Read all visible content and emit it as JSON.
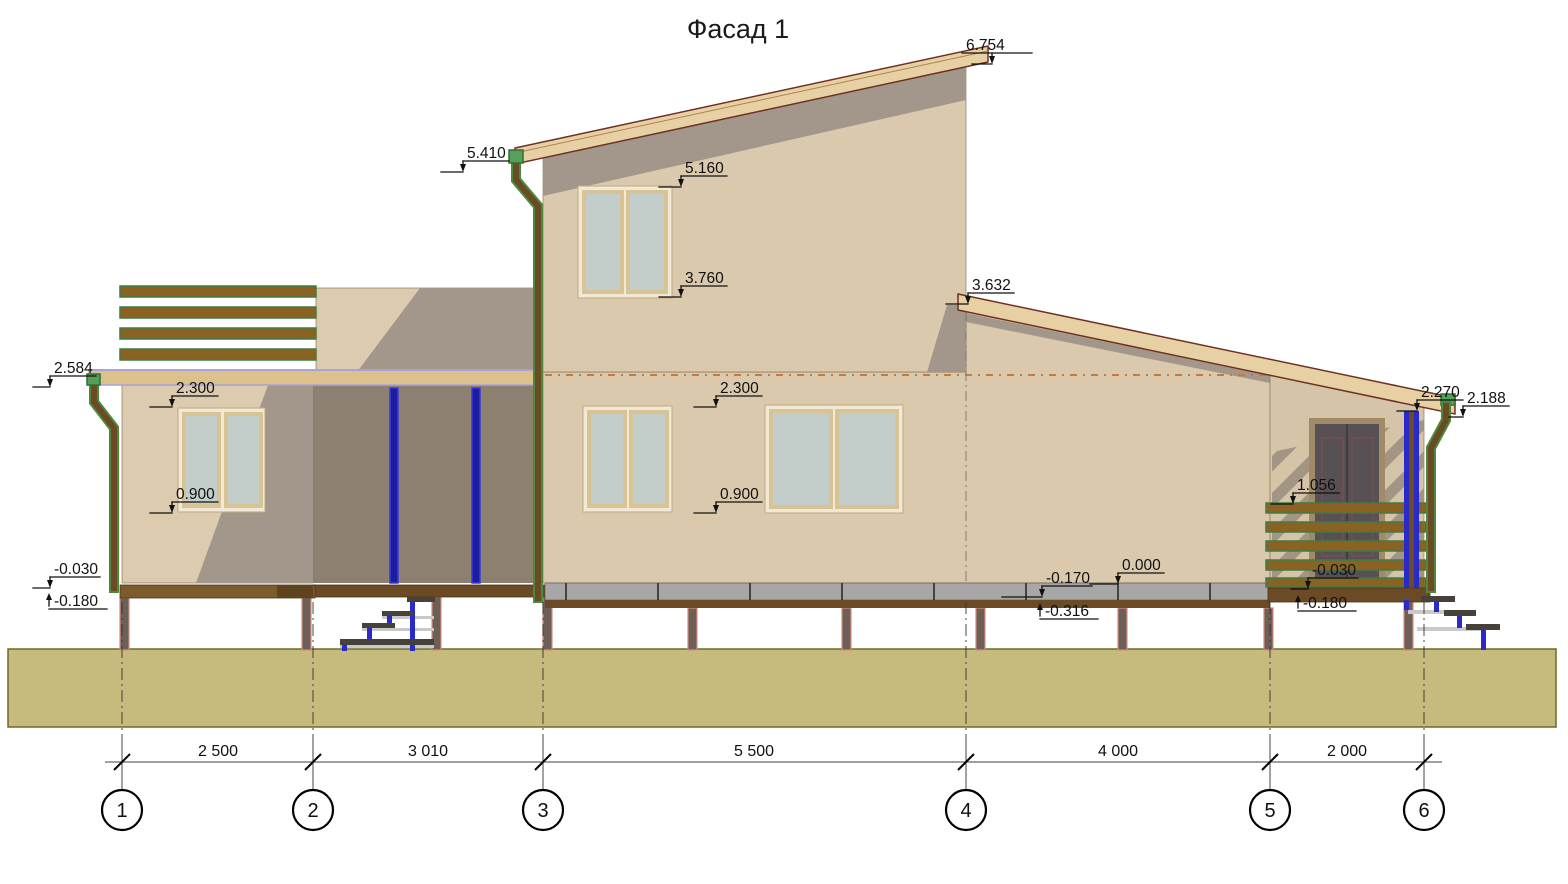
{
  "title": "Фасад 1",
  "markers": [
    {
      "name": "roof-high-peak",
      "value": "6.754"
    },
    {
      "name": "roof-high-eave",
      "value": "5.410"
    },
    {
      "name": "upper-window-top",
      "value": "5.160"
    },
    {
      "name": "upper-window-bottom",
      "value": "3.760"
    },
    {
      "name": "low-roof-start",
      "value": "3.632"
    },
    {
      "name": "left-wing-roof",
      "value": "2.584"
    },
    {
      "name": "left-window-top",
      "value": "2.300"
    },
    {
      "name": "left-window-bottom",
      "value": "0.900"
    },
    {
      "name": "main-window-top",
      "value": "2.300"
    },
    {
      "name": "main-window-bottom",
      "value": "0.900"
    },
    {
      "name": "porch-roof-under",
      "value": "2.270"
    },
    {
      "name": "porch-roof-tip",
      "value": "2.188"
    },
    {
      "name": "railing-top",
      "value": "1.056"
    },
    {
      "name": "floor-zero",
      "value": "0.000"
    },
    {
      "name": "plinth-bottom",
      "value": "-0.170"
    },
    {
      "name": "left-base-top",
      "value": "-0.030"
    },
    {
      "name": "porch-base-top",
      "value": "-0.030"
    },
    {
      "name": "left-base-bottom",
      "value": "-0.180"
    },
    {
      "name": "main-base-bottom",
      "value": "-0.316"
    },
    {
      "name": "porch-base-bottom",
      "value": "-0.180"
    }
  ],
  "dimensions": {
    "values": [
      "2 500",
      "3 010",
      "5 500",
      "4 000",
      "2 000"
    ]
  },
  "axes": {
    "labels": [
      "1",
      "2",
      "3",
      "4",
      "5",
      "6"
    ]
  },
  "colors": {
    "wall_light": "#dbc9ad",
    "wall_shadow": "#a3968a",
    "roof_fascia": "#e7d1a4",
    "roof_edge": "#6e3120",
    "ground": "#c6bb7d",
    "plinth_gray": "#a7a7a7",
    "base_brown": "#6b4a26",
    "slat_brown": "#8a6323",
    "slat_green": "#3e7c46",
    "post_blue": "#2a2ac8",
    "glass": "#c3cdc9",
    "frame_cream": "#f1e9d6",
    "slab_lavender": "#a9a2d6",
    "pile_edge_red": "#d98a7a",
    "door_dark": "#575055",
    "floor_dash_orange": "#c87a3c"
  }
}
